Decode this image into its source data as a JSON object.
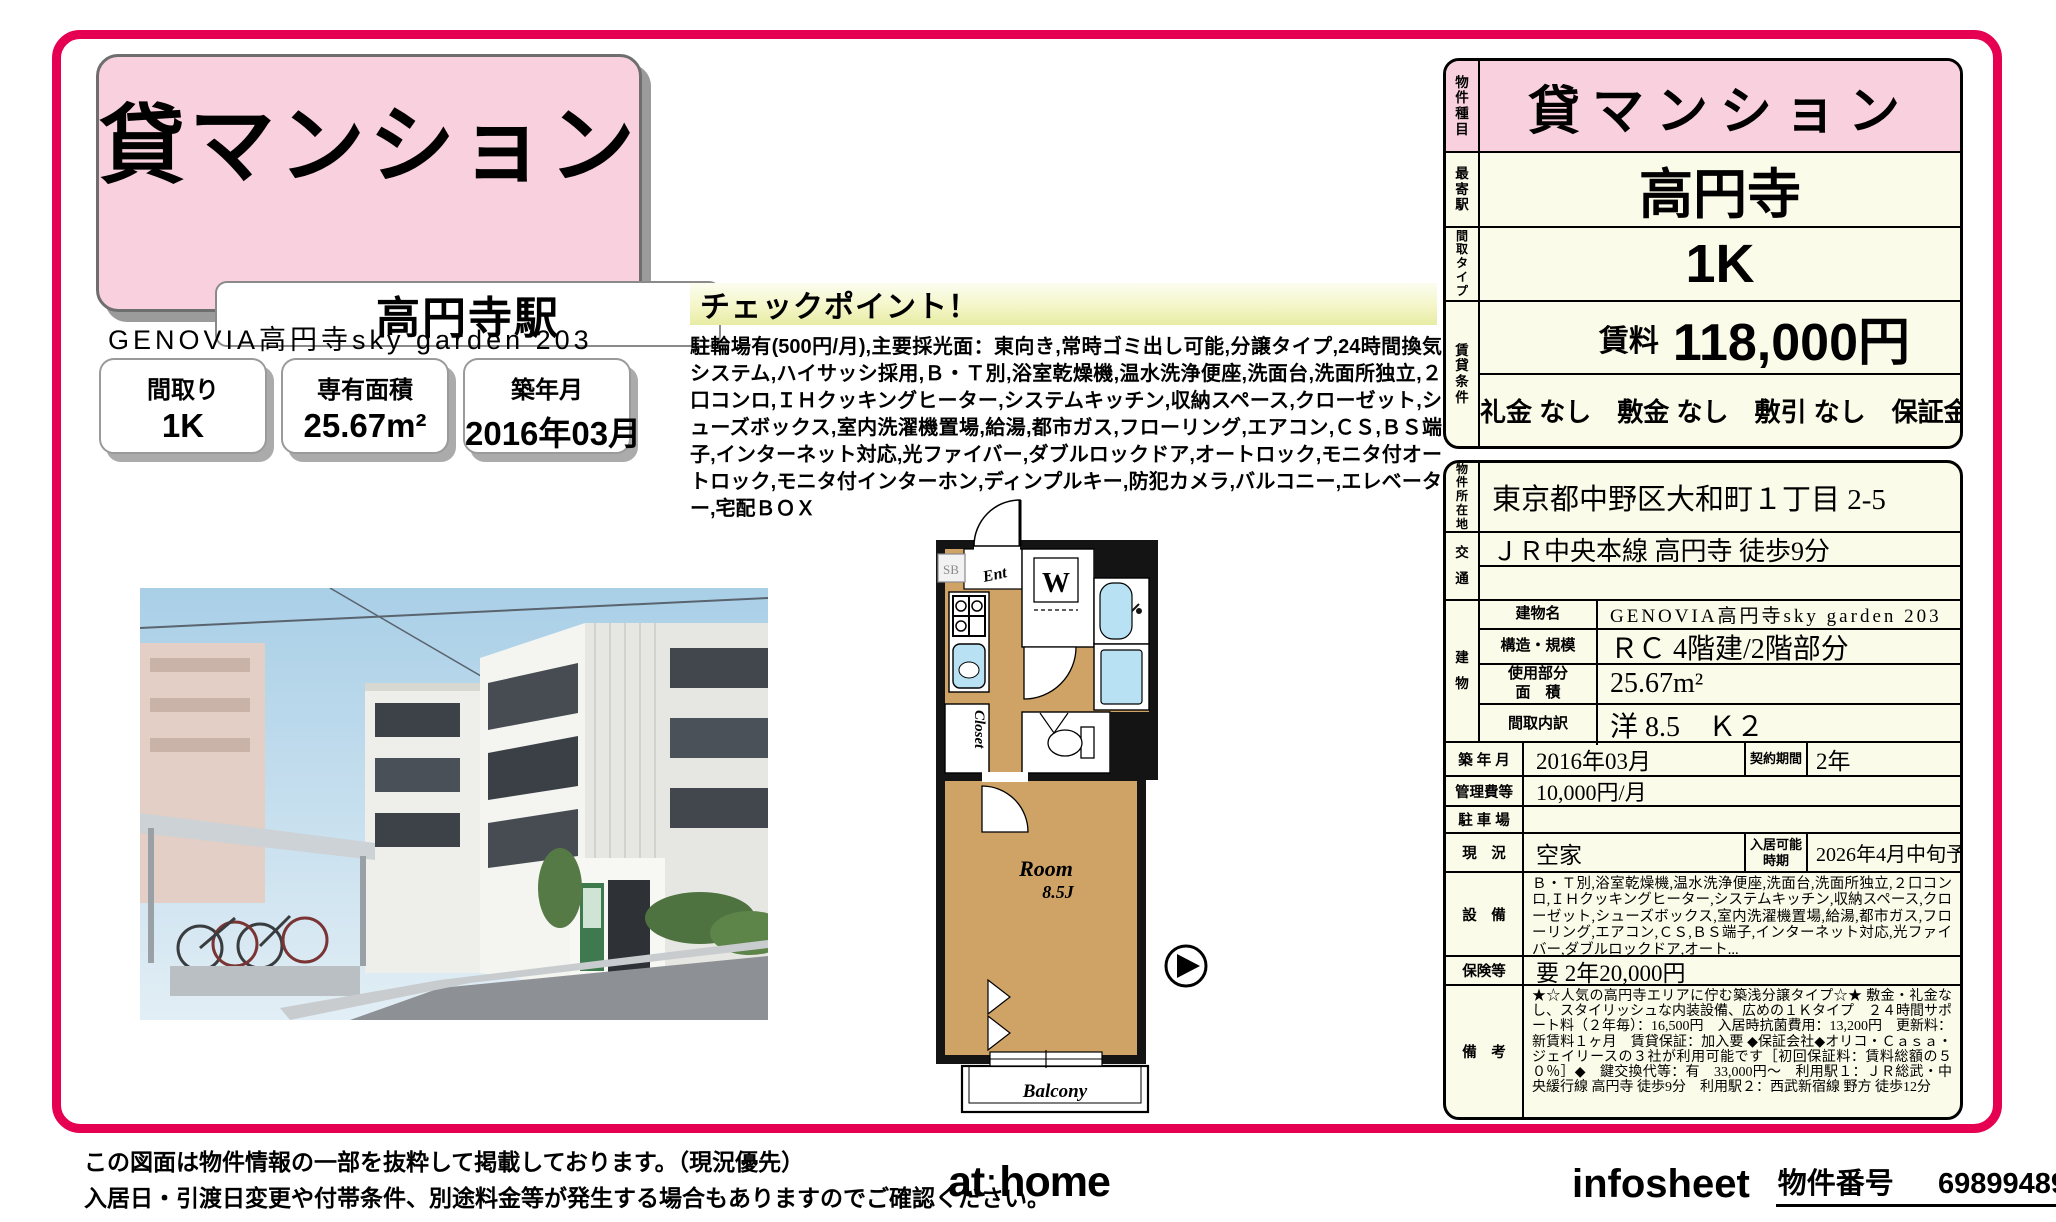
{
  "colors": {
    "accent": "#e50051",
    "pink": "#f9d1de",
    "cream": "#fbfbe9",
    "room_tan": "#cfa365",
    "fixture_blue": "#b8e2f4"
  },
  "header": {
    "category": "貸マンション",
    "station": "高円寺駅",
    "building": "GENOVIA高円寺sky garden 203",
    "badge1_label": "間取り",
    "badge1_value": "1K",
    "badge2_label": "専有面積",
    "badge2_value": "25.67m²",
    "badge3_label": "築年月",
    "badge3_value": "2016年03月"
  },
  "checkpoint": {
    "title": "チェックポイント！",
    "body": "駐輪場有(500円/月),主要採光面：東向き,常時ゴミ出し可能,分譲タイプ,24時間換気システム,ハイサッシ採用,Ｂ・Ｔ別,浴室乾燥機,温水洗浄便座,洗面台,洗面所独立,２口コンロ,ＩＨクッキングヒーター,システムキッチン,収納スペース,クローゼット,シューズボックス,室内洗濯機置場,給湯,都市ガス,フローリング,エアコン,ＣＳ,ＢＳ端子,インターネット対応,光ファイバー,ダブルロックドア,オートロック,モニタ付オートロック,モニタ付インターホン,ディンプルキー,防犯カメラ,バルコニー,エレベーター,宅配ＢＯＸ"
  },
  "floorplan": {
    "ent": "Ent",
    "sb": "SB",
    "washer": "W",
    "closet": "Closet",
    "room_name": "Room",
    "room_size": "8.5J",
    "balcony": "Balcony"
  },
  "summary": {
    "type_label": "物件種目",
    "type_value": "貸マンション",
    "station_label": "最寄駅",
    "station_value": "高円寺",
    "plan_label": "間取タイプ",
    "plan_value": "1K",
    "terms_label": "賃貸条件",
    "rent_label": "賃料",
    "rent_value": "118,000円",
    "terms_value": "礼金 なし　敷金 なし　敷引 なし　保証金 なし"
  },
  "details": {
    "loc_label": "物件所在地",
    "loc_value": "東京都中野区大和町１丁目 2-5",
    "access_label": "交通",
    "access_value": "ＪＲ中央本線 高円寺 徒歩9分",
    "access_value2": "",
    "building_label": "建物",
    "bname_label": "建物名",
    "bname_value": "GENOVIA高円寺sky garden 203",
    "struct_label": "構造・規模",
    "struct_value": "ＲＣ 4階建/2階部分",
    "area_label": "使用部分\n面　積",
    "area_value": "25.67m²",
    "layout_label": "間取内訳",
    "layout_value": "洋 8.5　Ｋ２",
    "built_label": "築 年 月",
    "built_value": "2016年03月",
    "contract_label": "契約期間",
    "contract_value": "2年",
    "fee_label": "管理費等",
    "fee_value": "10,000円/月",
    "parking_label": "駐 車 場",
    "parking_value": "",
    "status_label": "現　況",
    "status_value": "空家",
    "movein_label": "入居可能\n時期",
    "movein_value": "2026年4月中旬予定",
    "equip_label": "設　備",
    "equip_value": "Ｂ・Ｔ別,浴室乾燥機,温水洗浄便座,洗面台,洗面所独立,２口コンロ,ＩＨクッキングヒーター,システムキッチン,収納スペース,クローゼット,シューズボックス,室内洗濯機置場,給湯,都市ガス,フローリング,エアコン,ＣＳ,ＢＳ端子,インターネット対応,光ファイバー,ダブルロックドア,オート...",
    "insurance_label": "保険等",
    "insurance_value": "要 2年20,000円",
    "remarks_label": "備　考",
    "remarks_value": "★☆人気の高円寺エリアに佇む築浅分譲タイプ☆★ 敷金・礼金なし、スタイリッシュな内装設備、広めの１Ｋタイプ　２４時間サポート料（２年毎）：16,500円　入居時抗菌費用：13,200円　更新料：新賃料１ヶ月　賃貸保証：加入要 ◆保証会社◆オリコ・Ｃａｓａ・ジェイリースの３社が利用可能です［初回保証料：賃料総額の５０％］◆　鍵交換代等：有　33,000円～　利用駅１：ＪＲ総武・中央緩行線 高円寺 徒歩9分　利用駅２：西武新宿線 野方 徒歩12分"
  },
  "footer": {
    "note1": "この図面は物件情報の一部を抜粋して掲載しております。（現況優先）",
    "note2": "入居日・引渡日変更や付帯条件、別途料金等が発生する場合もありますのでご確認ください。",
    "logo_at": "at",
    "logo_dot": "·",
    "logo_home": "home",
    "infosheet": "infosheet",
    "property_no_label": "物件番号",
    "property_no": "69899489077"
  }
}
